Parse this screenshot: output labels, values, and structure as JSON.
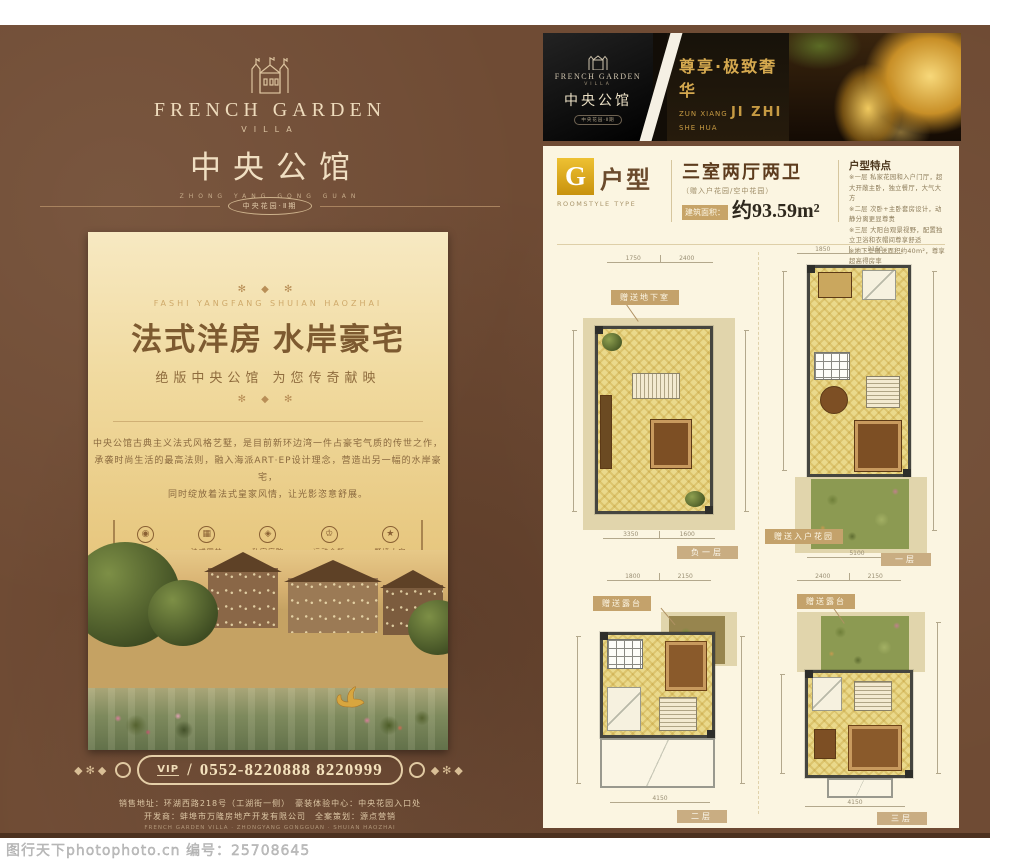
{
  "watermark": {
    "text": "图行天下photophoto.cn 编号：25708645"
  },
  "brand": {
    "name_en": "FRENCH GARDEN",
    "villa": "VILLA",
    "name_cn": "中央公馆",
    "name_pinyin": "ZHONG YANG GONG GUAN",
    "phase_badge": "中央花园·Ⅱ期"
  },
  "left_flyer": {
    "poster": {
      "ornament_top": "✻ ◆ ✻",
      "pinyin": "FASHI YANGFANG SHUIAN HAOZHAI",
      "title": "法式洋房 水岸豪宅",
      "subtitle": "绝版中央公馆 为您传奇献映",
      "ornament_bottom": "✻ ◆ ✻",
      "paragraph": [
        "中央公馆古典主义法式风格艺墅，是目前新环边湾一件占豪宅气质的传世之作，",
        "承袭时尚生活的最高法则，融入海派ART·EP设计理念，营造出另一幅的水岸豪宅，",
        "同时绽放着法式皇家风情，让光影恣意舒展。"
      ],
      "amenities": [
        {
          "icon": "city-center-medallion-icon",
          "glyph": "◉",
          "label": "城市中心"
        },
        {
          "icon": "french-garden-medallion-icon",
          "glyph": "▦",
          "label": "法式园林"
        },
        {
          "icon": "private-court-medallion-icon",
          "glyph": "◈",
          "label": "私家庭院"
        },
        {
          "icon": "club-medallion-icon",
          "glyph": "♔",
          "label": "运动会所"
        },
        {
          "icon": "mansion-medallion-icon",
          "glyph": "★",
          "label": "墅境大宅"
        }
      ]
    },
    "hotline": {
      "ornament_left": "◆✻◆",
      "vip_label": "VIP",
      "separator": "/",
      "number": "0552-8220888 8220999",
      "ornament_right": "◆✻◆"
    },
    "footer": {
      "line1": "销售地址：环湖西路218号（工湖街一侧）　豪装体验中心：中央花园入口处",
      "line2": "开发商：蚌埠市万隆房地产开发有限公司　全案策划：源点营销",
      "line3": "FRENCH GARDEN VILLA · ZHONGYANG GONGGUAN · SHUIAN HAOZHAI"
    }
  },
  "banner": {
    "slogan_cn": "尊享·极致奢华",
    "slogan_py1": "ZUN XIANG",
    "slogan_py_big": "JI ZHI",
    "slogan_py2": "SHE HUA"
  },
  "unit_page": {
    "type_letter": "G",
    "type_label": "户型",
    "type_sub": "ROOMSTYLE TYPE",
    "rooms_title": "三室两厅两卫",
    "rooms_sub": "（赠入户花园/空中花园）",
    "area_label": "建筑面积：",
    "area_value": "约93.59m²",
    "features_title": "户型特点",
    "features": [
      "※一层 私家花园和入户门厅，超大开敞主卧，独立餐厅，大气大方",
      "※二层 次卧+主卧套房设计，动静分离更显尊贵",
      "※三层 大阳台观景视野，配置独立卫浴和衣帽间尊享舒适",
      "※地下室赠送面积约40m²，尊享超高得房率"
    ],
    "plans": [
      {
        "tag": "赠送地下室",
        "floor": "负一层",
        "dim_top_1": "1750",
        "dim_top_2": "2400",
        "dim_bottom_1": "3350",
        "dim_bottom_2": "1600"
      },
      {
        "tag": "赠送入户花园",
        "floor": "一层",
        "dim_top_1": "1850",
        "dim_top_2": "2150",
        "dim_bottom_1": "5100"
      },
      {
        "tag": "赠送露台",
        "floor": "二层",
        "dim_top_1": "1800",
        "dim_top_2": "2150",
        "dim_bottom_1": "4150"
      },
      {
        "tag": "赠送露台",
        "floor": "三层",
        "dim_top_1": "2400",
        "dim_top_2": "2150",
        "dim_bottom_1": "4150"
      }
    ]
  }
}
